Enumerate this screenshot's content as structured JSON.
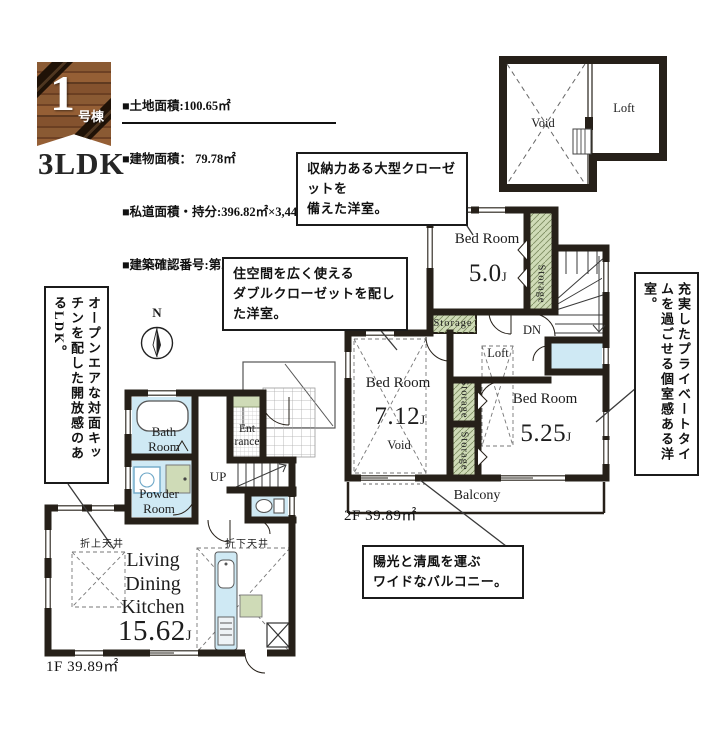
{
  "header": {
    "badge_number": "1",
    "badge_suffix": "号棟",
    "plan_type": "3LDK",
    "info_lines": [
      "■土地面積:100.65㎡",
      "■建物面積： 79.78㎡",
      "■私道面積・持分:396.82㎡×3,446/79,364",
      "■建築確認番号:第25UDI1W建04266号"
    ]
  },
  "callouts": {
    "closet": "収納力ある大型クローゼットを\n備えた洋室。",
    "double_closet": "住空間を広く使える\nダブルクローゼットを配した洋室。",
    "open_kitchen": "オープンエアな対面キッチンを配した開放感のあるLDK。",
    "private_room": "充実したプライベートタイムを過ごせる個室感ある洋室。",
    "balcony": "陽光と清風を運ぶ\nワイドなバルコニー。"
  },
  "loft_plan": {
    "void_label": "Void",
    "loft_label": "Loft"
  },
  "floor2": {
    "area_label": "2F 39.89㎡",
    "bed1_name": "Bed Room",
    "bed1_size": "5.0",
    "bed1_unit": "J",
    "bed2_name": "Bed Room",
    "bed2_size": "7.12",
    "bed2_unit": "J",
    "bed3_name": "Bed Room",
    "bed3_size": "5.25",
    "bed3_unit": "J",
    "void_label": "Void",
    "loft_label": "Loft",
    "dn_label": "DN",
    "balcony_label": "Balcony",
    "storage_label": "Storage"
  },
  "floor1": {
    "area_label": "1F 39.89㎡",
    "bath": "Bath\nRoom",
    "powder": "Powder\nRoom",
    "entrance": "Ent\nrance",
    "up_label": "UP",
    "ldk_name": "Living\nDining\nKitchen",
    "ldk_size": "15.62",
    "ldk_unit": "J",
    "ceiling_raised": "折上天井",
    "ceiling_lowered": "折下天井",
    "compass_n": "N"
  },
  "colors": {
    "wall": "#262019",
    "water_blue": "#cfe9f4",
    "storage_green": "#cfdbb7",
    "wood_brown": "#8a5a33"
  }
}
